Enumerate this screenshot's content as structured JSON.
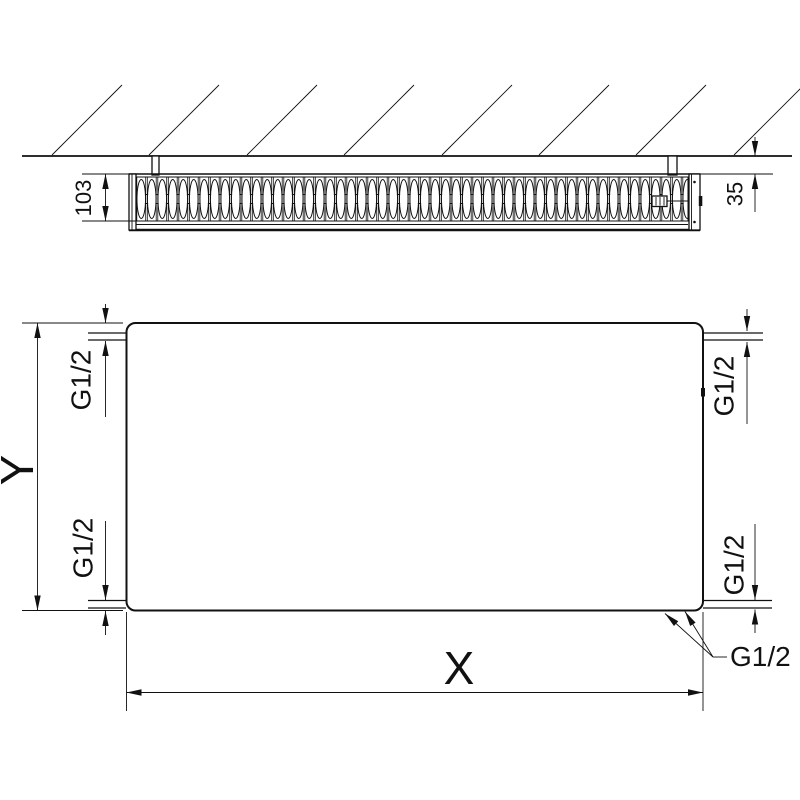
{
  "top_view": {
    "depth_label": "103",
    "wall_distance_label": "35"
  },
  "front_view": {
    "width_label": "X",
    "height_label": "Y",
    "connections": {
      "top_left": "G1/2",
      "bottom_left": "G1/2",
      "top_right": "G1/2",
      "bottom_right": "G1/2",
      "bottom_leader": "G1/2"
    }
  },
  "colors": {
    "line": "#111111",
    "background": "#ffffff"
  }
}
